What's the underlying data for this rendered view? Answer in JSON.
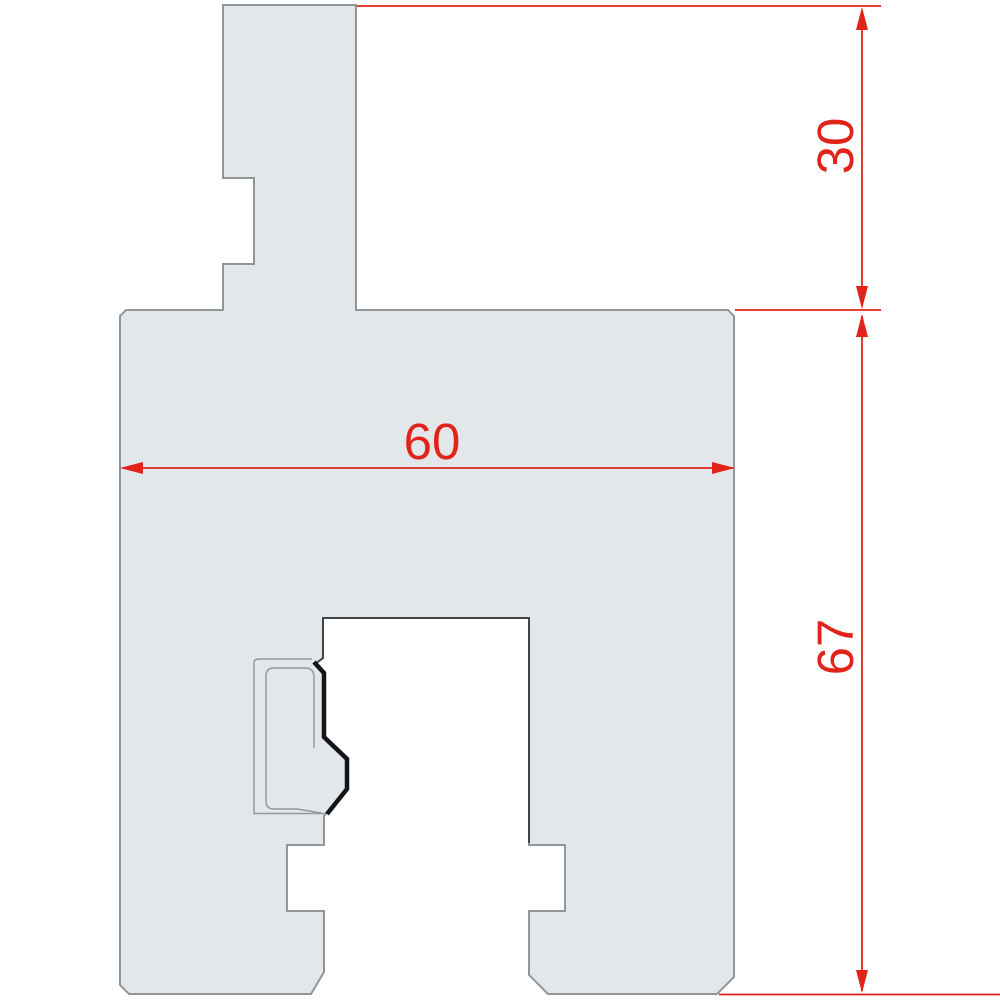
{
  "drawing": {
    "description": "2D cross-section profile of a press-brake tool with red dimension annotations",
    "units_shown": false,
    "dimensions": [
      {
        "id": "upper-tang-height",
        "value": "30",
        "orientation": "vertical"
      },
      {
        "id": "body-width",
        "value": "60",
        "orientation": "horizontal"
      },
      {
        "id": "body-height",
        "value": "67",
        "orientation": "vertical"
      }
    ],
    "colors": {
      "dimension_red": "#e2231a",
      "part_fill": "#e3e7ea",
      "part_outline": "#8f979d",
      "slot_edge_dark": "#3f444a",
      "contour_black": "#121417",
      "background": "#ffffff"
    }
  }
}
